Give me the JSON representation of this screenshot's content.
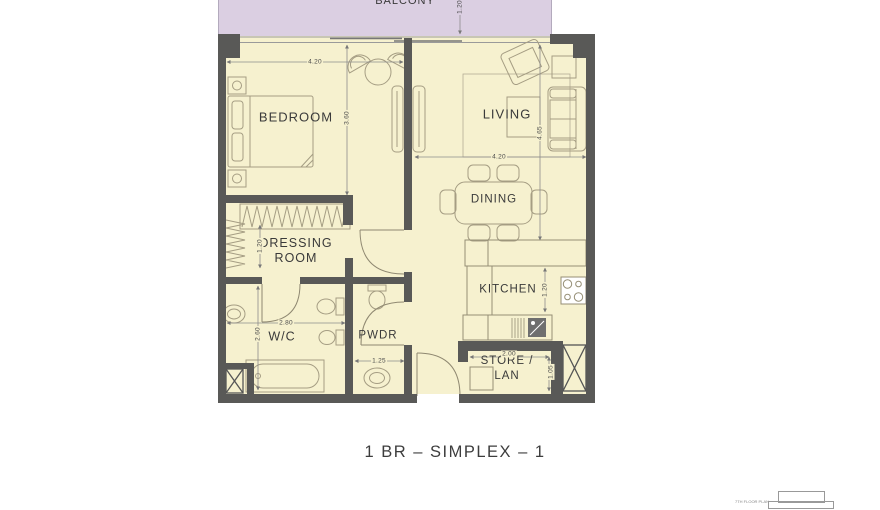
{
  "title": "1 BR – SIMPLEX – 1",
  "rooms": {
    "balcony": "BALCONY",
    "bedroom": "BEDROOM",
    "living": "LIVING",
    "dining": "DINING",
    "kitchen": "KITCHEN",
    "dressing": "DRESSING\nROOM",
    "wc": "W/C",
    "pwdr": "PWDR",
    "store": "STORE /\nLAN"
  },
  "dimensions": {
    "bedroom_width": "4.20",
    "bedroom_depth": "3.60",
    "living_width": "4.20",
    "living_depth": "4.65",
    "kitchen_depth": "1.20",
    "wc_width": "2.80",
    "wc_depth": "2.60",
    "pwdr_width": "1.25",
    "store_width": "2.00",
    "store_depth": "1.05",
    "dressing_depth": "1.20",
    "balcony_depth": "1.20"
  },
  "key_plan": {
    "caption": "7TH FLOOR PLAN"
  },
  "colors": {
    "floor": "#f6f1cf",
    "balcony": "#dbcfe2",
    "wall": "#595957",
    "furniture_line": "#a59d83",
    "dimension_line": "#8c8c8c",
    "label_text": "#3a3a3a"
  }
}
